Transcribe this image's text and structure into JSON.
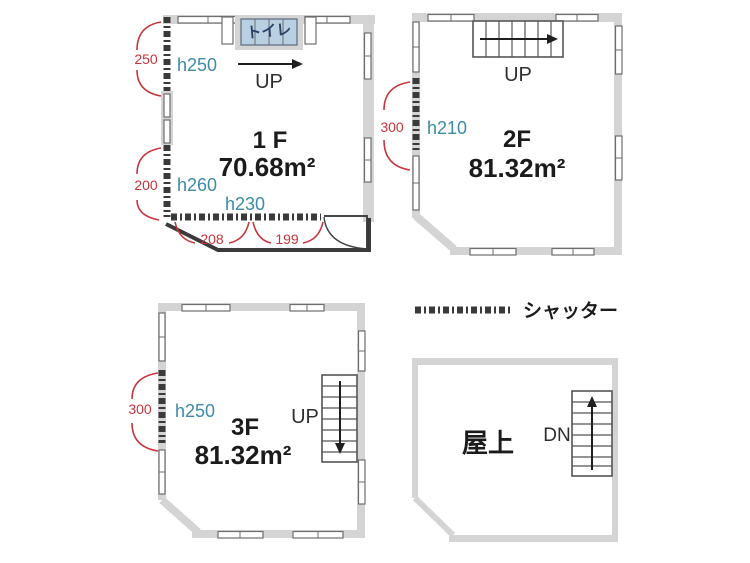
{
  "colors": {
    "red": "#c9353c",
    "teal": "#3d8ba6",
    "wall": "#d4d4d4",
    "dark": "#3a3a3a",
    "toilet_fill": "#b9cfe2",
    "toilet_text": "#2a3f66"
  },
  "plans": {
    "f1": {
      "name": "1 F",
      "area": "70.68m²",
      "toilet_label": "トイレ",
      "up_label": "UP",
      "h_top": "h250",
      "h_mid": "h260",
      "h_bottom": "h230",
      "dim_left_top": "250",
      "dim_left_bottom": "200",
      "dim_bottom_left": "208",
      "dim_bottom_right": "199"
    },
    "f2": {
      "name": "2F",
      "area": "81.32m²",
      "up_label": "UP",
      "height": "h210",
      "dim_left": "300"
    },
    "f3": {
      "name": "3F",
      "area": "81.32m²",
      "up_label": "UP",
      "height": "h250",
      "dim_left": "300"
    },
    "roof": {
      "name": "屋上",
      "dn_label": "DN"
    }
  },
  "legend": {
    "label": "シャッター"
  }
}
